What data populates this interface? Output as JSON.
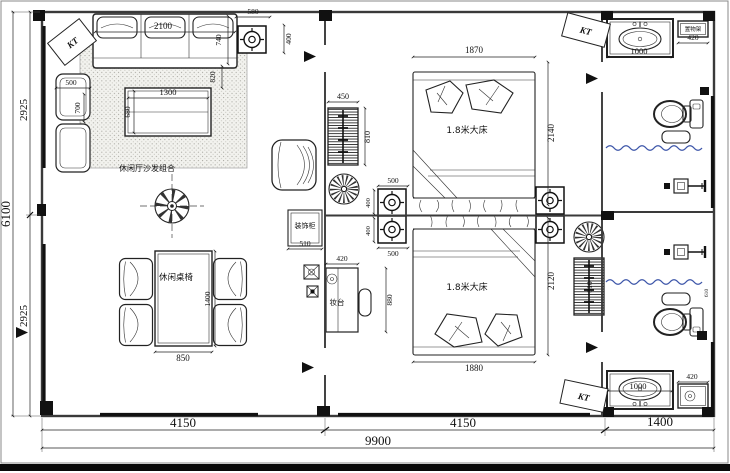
{
  "colors": {
    "curtain": "#3d56a9",
    "line": "#222222"
  },
  "overall_dims": {
    "total_width": "9900",
    "living_width": "4150",
    "bedroom_width": "4150",
    "bath_width": "1400",
    "total_height": "6100",
    "height_upper": "2925",
    "height_lower": "2925"
  },
  "living_room": {
    "ac_label": "KT",
    "sofa_area_label": "休闲厅沙发组合",
    "sofa_width": "2100",
    "sofa_depth": "740",
    "sofa_table_gap": "820",
    "ceiling_speaker_width": "580",
    "ceiling_speaker_depth": "400",
    "side_sofa_width": "500",
    "side_sofa_depth": "700",
    "coffee_table_width": "1300",
    "coffee_table_depth": "680",
    "dining_label": "休闲桌椅",
    "dining_table_length": "1400",
    "dining_table_width": "850",
    "deco_cabinet_label": "装饰柜",
    "deco_cabinet_width": "510"
  },
  "bedroom_top": {
    "ac_label": "KT",
    "bed_label": "1.8米大床",
    "bed_width": "1870",
    "bed_length": "2140",
    "cabinet_width": "450",
    "cabinet_depth": "810",
    "speaker_width": "500",
    "speaker_depth": "400"
  },
  "bedroom_bottom": {
    "ac_label": "KT",
    "bed_label": "1.8米大床",
    "bed_width": "1880",
    "bed_length": "2120",
    "cabinet_depth": "810",
    "dresser_label": "妆台",
    "dresser_width": "420",
    "dresser_length": "880",
    "speaker_width": "500",
    "speaker_depth": "400"
  },
  "bath_top": {
    "vanity_width": "1000",
    "shelf_label": "置物架",
    "shelf_width": "420"
  },
  "bath_bottom": {
    "vanity_width": "1000",
    "shelf_width": "420",
    "shower_dim": "610"
  }
}
